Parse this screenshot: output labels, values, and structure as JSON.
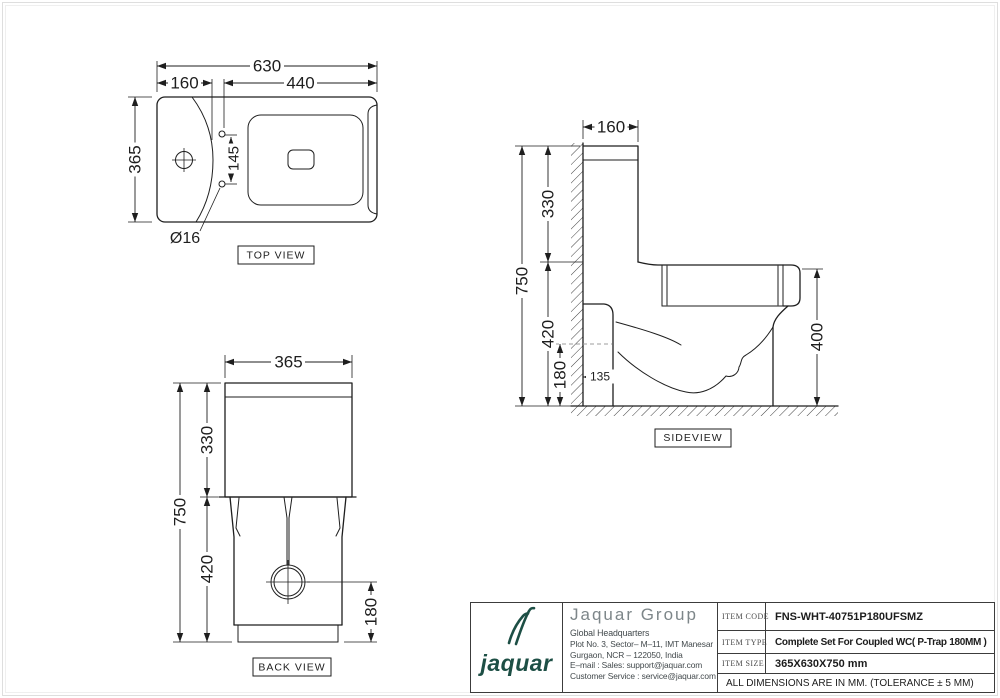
{
  "colors": {
    "line": "#1e1e1e",
    "logo_green": "#1d4f45",
    "company_gray": "#7d8689"
  },
  "views": {
    "top": {
      "label": "TOP VIEW",
      "dims": {
        "overall_width": "630",
        "tank_depth": "160",
        "seat_length": "440",
        "overall_depth": "365",
        "bolt_spacing": "145",
        "bolt_diameter": "Ø16"
      }
    },
    "side": {
      "label": "SIDEVIEW",
      "dims": {
        "tank_depth": "160",
        "tank_height": "330",
        "overall_height": "750",
        "rim_height": "420",
        "trap_height": "180",
        "trap_offset": "135",
        "seat_height": "400"
      }
    },
    "back": {
      "label": "BACK VIEW",
      "dims": {
        "overall_width": "365",
        "tank_height": "330",
        "overall_height": "750",
        "base_height": "420",
        "outlet_height": "180"
      }
    }
  },
  "title_block": {
    "logo_text": "jaquar",
    "company": "Jaquar Group",
    "hq": "Global Headquarters",
    "address_line1": "Plot No. 3, Sector– M–11, IMT Manesar",
    "address_line2": "Gurgaon, NCR – 122050, India",
    "email_line": "E–mail : Sales: support@jaquar.com",
    "service_line": "Customer Service : service@jaquar.com",
    "rows": [
      {
        "label": "ITEM CODE",
        "value": "FNS-WHT-40751P180UFSMZ"
      },
      {
        "label": "ITEM TYPE",
        "value": "Complete Set For Coupled WC( P-Trap 180MM )"
      },
      {
        "label": "ITEM SIZE",
        "value": "365X630X750 mm"
      }
    ],
    "note": "ALL DIMENSIONS ARE IN MM. (TOLERANCE ± 5 MM)"
  }
}
